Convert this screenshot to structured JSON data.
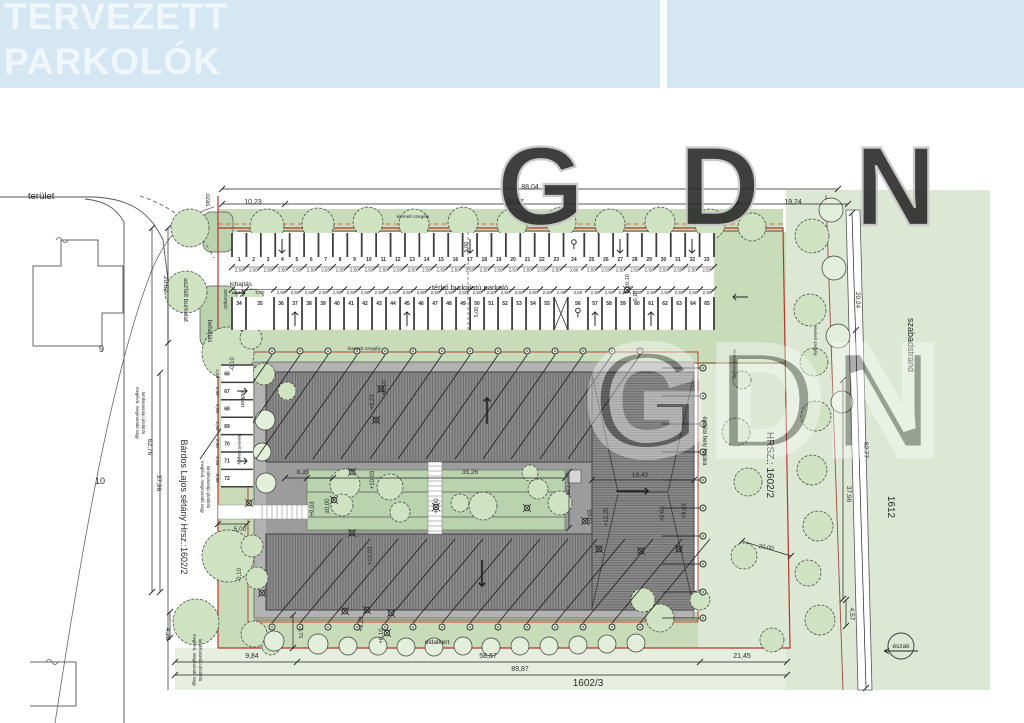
{
  "header": {
    "line1": "TERVEZETT",
    "line2": "PARKOLÓK"
  },
  "watermark": {
    "text": "GDN"
  },
  "colors": {
    "header_bg": "#d6e7f4",
    "header_text": "#eff6fc",
    "site_green": "#dce8d4",
    "strip_green": "#c8dcba",
    "island_green": "#b9d3ae",
    "tree_fill": "#cfe3c3",
    "pale_tree": "#e4efdb",
    "boundary_red": "#b4372b",
    "curb_brown": "#8a7750",
    "roof_gray": "#8a8a8a",
    "slab_gray": "#b2b2b2",
    "corridor_gray": "#9c9c9c"
  },
  "plan": {
    "parking": {
      "row1": {
        "numbers": [
          "1",
          "2",
          "3",
          "4",
          "5",
          "6",
          "7",
          "8",
          "9",
          "10",
          "11",
          "12",
          "13",
          "14",
          "15",
          "16",
          "17",
          "18",
          "19",
          "20",
          "21",
          "22",
          "23",
          "24",
          "25",
          "26",
          "27",
          "28",
          "29",
          "30",
          "31",
          "32",
          "33"
        ],
        "dims": [
          "2,50",
          "2,50",
          "2,50",
          "2,50",
          "2,50",
          "2,50",
          "2,50",
          "2,50",
          "2,50",
          "2,50",
          "2,50",
          "2,50",
          "2,50",
          "2,50",
          "2,50",
          "2,50",
          "2,50",
          "2,50",
          "2,50",
          "2,50",
          "2,50",
          "2,50",
          "2,50",
          "3,60",
          "2,50",
          "2,50",
          "2,50",
          "2,50",
          "2,50",
          "2,50",
          "2,50",
          "2,50",
          "2,50"
        ],
        "disabled_stall": "24"
      },
      "row2": {
        "numbers": [
          "34",
          "35",
          "36",
          "37",
          "38",
          "39",
          "40",
          "41",
          "42",
          "43",
          "44",
          "45",
          "46",
          "47",
          "48",
          "49",
          "50",
          "51",
          "52",
          "53",
          "54",
          "55",
          "",
          "56",
          "57",
          "58",
          "59",
          "60",
          "61",
          "62",
          "63",
          "64",
          "65"
        ],
        "dims": [
          "2,50",
          "5,00",
          "2,50",
          "2,50",
          "2,50",
          "2,50",
          "2,50",
          "2,50",
          "2,50",
          "2,50",
          "2,50",
          "2,50",
          "2,50",
          "2,50",
          "2,50",
          "2,50",
          "2,50",
          "2,50",
          "2,50",
          "2,50",
          "2,50",
          "2,50",
          "2,45",
          "3,60",
          "2,50",
          "2,50",
          "2,50",
          "2,50",
          "2,50",
          "2,50",
          "2,50",
          "2,50",
          "2,50"
        ],
        "disabled_stall": "56"
      },
      "left_column": {
        "numbers": [
          "66",
          "67",
          "68",
          "69",
          "70",
          "71",
          "72"
        ],
        "dims": [
          "2,50",
          "2,50",
          "2,50",
          "2,50",
          "2,50",
          "2,50",
          "2,50"
        ]
      }
    },
    "labels": [
      {
        "t": "terület",
        "x": 28,
        "y": 199,
        "s": 9.5
      },
      {
        "t": "ozás",
        "x": 206,
        "y": 200,
        "s": 6,
        "r": 90,
        "a": "middle"
      },
      {
        "t": "88,04",
        "x": 530,
        "y": 189,
        "s": 7,
        "a": "middle"
      },
      {
        "t": "10,23",
        "x": 253,
        "y": 204,
        "s": 7,
        "a": "middle"
      },
      {
        "t": "58,57",
        "x": 515,
        "y": 204,
        "s": 7,
        "a": "middle"
      },
      {
        "t": "19,24",
        "x": 793,
        "y": 204,
        "s": 7,
        "a": "middle"
      },
      {
        "t": "kiemelt szegély",
        "x": 413,
        "y": 218,
        "s": 4.8,
        "a": "middle"
      },
      {
        "t": "kihajtás",
        "x": 230,
        "y": 286,
        "s": 6.5
      },
      {
        "t": "térkő burkolatú parkoló",
        "x": 470,
        "y": 290,
        "s": 7.5,
        "a": "middle"
      },
      {
        "t": "sorompó",
        "x": 224,
        "y": 299,
        "s": 5,
        "r": 90,
        "a": "middle"
      },
      {
        "t": "behajtás",
        "x": 208,
        "y": 331,
        "s": 6,
        "r": 90,
        "a": "middle"
      },
      {
        "t": "aszfalt burkolat",
        "x": 184,
        "y": 300,
        "s": 6.5,
        "r": 90,
        "a": "middle"
      },
      {
        "t": "20,52",
        "x": 164,
        "y": 284,
        "s": 6.5,
        "r": 90,
        "a": "middle"
      },
      {
        "t": "62,76",
        "x": 148,
        "y": 447,
        "s": 6.5,
        "r": 90,
        "a": "middle"
      },
      {
        "t": "37,96",
        "x": 157,
        "y": 483,
        "s": 6.5,
        "r": 90,
        "a": "middle"
      },
      {
        "t": "Bárdos Lajos sétány Hrsz.:1602/2",
        "x": 181,
        "y": 507,
        "s": 9,
        "r": 90,
        "a": "middle"
      },
      {
        "t": "4,28",
        "x": 166,
        "y": 634,
        "s": 6.5,
        "r": 90,
        "a": "middle"
      },
      {
        "t": "9",
        "x": 99,
        "y": 352,
        "s": 9
      },
      {
        "t": "10",
        "x": 95,
        "y": 484,
        "s": 9
      },
      {
        "t": "meglévő, megmaradó nagy",
        "x": 136,
        "y": 413,
        "s": 4.3,
        "r": 90,
        "a": "middle"
      },
      {
        "t": "lombkoronájú platánfa",
        "x": 142,
        "y": 413,
        "s": 4.3,
        "r": 90,
        "a": "middle"
      },
      {
        "t": "meglévő, megmaradó nagy",
        "x": 201,
        "y": 487,
        "s": 4.3,
        "r": 90,
        "a": "middle"
      },
      {
        "t": "lombkoronájú platánfa",
        "x": 207,
        "y": 487,
        "s": 4.3,
        "r": 90,
        "a": "middle"
      },
      {
        "t": "meglévő, megmaradó nagy",
        "x": 193,
        "y": 660,
        "s": 4.3,
        "r": 90,
        "a": "middle"
      },
      {
        "t": "lombkoronájú platánfa",
        "x": 199,
        "y": 660,
        "s": 4.3,
        "r": 90,
        "a": "middle"
      },
      {
        "t": "előkert",
        "x": 241,
        "y": 399,
        "s": 5.5,
        "r": 90,
        "a": "middle"
      },
      {
        "t": "kiemelt szegély",
        "x": 238,
        "y": 450,
        "s": 4.3,
        "r": 90,
        "a": "middle"
      },
      {
        "t": "-0,10",
        "x": 234,
        "y": 364,
        "s": 6,
        "r": -90,
        "a": "middle"
      },
      {
        "t": "-0,10",
        "x": 241,
        "y": 575,
        "s": 6,
        "r": -90,
        "a": "middle"
      },
      {
        "t": "5,00",
        "x": 240,
        "y": 531,
        "s": 6.5,
        "a": "middle"
      },
      {
        "t": "8,35",
        "x": 303,
        "y": 474,
        "s": 6.5,
        "a": "middle"
      },
      {
        "t": "35,26",
        "x": 470,
        "y": 474,
        "s": 6.5,
        "a": "middle"
      },
      {
        "t": "18,42",
        "x": 640,
        "y": 477,
        "s": 6.5,
        "a": "middle"
      },
      {
        "t": "7,35",
        "x": 566,
        "y": 490,
        "s": 5,
        "r": 90,
        "a": "middle"
      },
      {
        "t": "kiemelt szegély",
        "x": 348,
        "y": 350,
        "s": 4.8
      },
      {
        "t": "±0,10",
        "x": 629,
        "y": 281,
        "s": 5.5,
        "r": -90,
        "a": "middle"
      },
      {
        "t": "0,10",
        "x": 637,
        "y": 296,
        "s": 5.5,
        "r": -90,
        "a": "middle"
      },
      {
        "t": "5,00",
        "x": 468,
        "y": 247,
        "s": 5.5,
        "r": -90,
        "a": "middle"
      },
      {
        "t": "5,00",
        "x": 478,
        "y": 312,
        "s": 5.5,
        "r": -90,
        "a": "middle"
      },
      {
        "t": "kiemelt szegély",
        "x": 733,
        "y": 364,
        "s": 4.3,
        "r": 90,
        "a": "middle"
      },
      {
        "t": "kiemelt szegély",
        "x": 814,
        "y": 341,
        "s": 4.3,
        "r": 90,
        "a": "middle"
      },
      {
        "t": "építési hely határa",
        "x": 703,
        "y": 441,
        "s": 6,
        "r": 90,
        "a": "middle"
      },
      {
        "t": "HRSZ.: 1602/2",
        "x": 767,
        "y": 465,
        "s": 10,
        "r": 90,
        "a": "middle",
        "c": "#4a4a4a"
      },
      {
        "t": "szabadstrand",
        "x": 908,
        "y": 345,
        "s": 9,
        "r": 90,
        "a": "middle",
        "c": "#3a3a3a"
      },
      {
        "t": "20,24",
        "x": 856,
        "y": 300,
        "s": 6.5,
        "r": 90,
        "a": "middle"
      },
      {
        "t": "62,77",
        "x": 864,
        "y": 450,
        "s": 6.5,
        "r": 90,
        "a": "middle"
      },
      {
        "t": "37,96",
        "x": 847,
        "y": 494,
        "s": 6.5,
        "r": 90,
        "a": "middle"
      },
      {
        "t": "4,57",
        "x": 850,
        "y": 614,
        "s": 6.5,
        "r": 90,
        "a": "middle"
      },
      {
        "t": "1612",
        "x": 888,
        "y": 507,
        "s": 10,
        "r": 90,
        "a": "middle",
        "c": "#4a4a4a"
      },
      {
        "t": "20,00",
        "x": 766,
        "y": 549,
        "s": 6,
        "r": 8,
        "a": "middle"
      },
      {
        "t": "9,84",
        "x": 252,
        "y": 658,
        "s": 7,
        "a": "middle"
      },
      {
        "t": "58,57",
        "x": 488,
        "y": 658,
        "s": 7,
        "a": "middle"
      },
      {
        "t": "21,45",
        "x": 742,
        "y": 658,
        "s": 7,
        "a": "middle"
      },
      {
        "t": "89,87",
        "x": 520,
        "y": 671,
        "s": 7,
        "a": "middle"
      },
      {
        "t": "1602/3",
        "x": 588,
        "y": 686,
        "s": 10,
        "a": "middle",
        "c": "#3a3a3a"
      },
      {
        "t": "3,75",
        "x": 299,
        "y": 633,
        "s": 5.5,
        "r": 90,
        "a": "middle"
      },
      {
        "t": "oldalkert",
        "x": 437,
        "y": 644,
        "s": 6.5,
        "a": "middle"
      },
      {
        "t": "+9,23",
        "x": 374,
        "y": 402,
        "s": 6,
        "r": -90,
        "a": "middle"
      },
      {
        "t": "+6,10",
        "x": 386,
        "y": 388,
        "s": 6,
        "r": -90,
        "a": "middle"
      },
      {
        "t": "+10,03",
        "x": 374,
        "y": 480,
        "s": 6,
        "r": -90,
        "a": "middle"
      },
      {
        "t": "±0,00",
        "x": 329,
        "y": 506,
        "s": 6,
        "r": -90,
        "a": "middle"
      },
      {
        "t": "+9,03",
        "x": 314,
        "y": 509,
        "s": 6,
        "r": -90,
        "a": "middle"
      },
      {
        "t": "+0,00",
        "x": 438,
        "y": 506,
        "s": 6,
        "r": -90,
        "a": "middle"
      },
      {
        "t": "+10,03",
        "x": 372,
        "y": 556,
        "s": 6,
        "r": -90,
        "a": "middle"
      },
      {
        "t": "+9,65",
        "x": 592,
        "y": 517,
        "s": 6,
        "r": -90,
        "a": "middle"
      },
      {
        "t": "+12,25",
        "x": 608,
        "y": 517,
        "s": 6,
        "r": -90,
        "a": "middle"
      },
      {
        "t": "+9,60",
        "x": 664,
        "y": 514,
        "s": 6,
        "r": -90,
        "a": "middle"
      },
      {
        "t": "+9,03",
        "x": 686,
        "y": 511,
        "s": 6,
        "r": -90,
        "a": "middle"
      },
      {
        "t": "+9,23",
        "x": 363,
        "y": 624,
        "s": 6,
        "r": -90,
        "a": "middle"
      },
      {
        "t": "+6,10",
        "x": 383,
        "y": 636,
        "s": 6,
        "r": -90,
        "a": "middle"
      },
      {
        "t": "észak",
        "x": 901,
        "y": 648,
        "s": 6.5,
        "a": "middle",
        "c": "#222222"
      }
    ],
    "level_markers": [
      [
        249,
        503
      ],
      [
        334,
        500
      ],
      [
        352,
        472
      ],
      [
        352,
        533
      ],
      [
        436,
        507
      ],
      [
        527,
        508
      ],
      [
        585,
        521
      ],
      [
        599,
        549
      ],
      [
        641,
        551
      ],
      [
        679,
        549
      ],
      [
        262,
        593
      ],
      [
        345,
        611
      ],
      [
        391,
        613
      ],
      [
        381,
        389
      ],
      [
        376,
        420
      ],
      [
        627,
        290
      ],
      [
        367,
        610
      ],
      [
        387,
        633
      ]
    ],
    "arrows": [
      {
        "x": 282,
        "y": 239,
        "d": "down",
        "l": 14
      },
      {
        "x": 470,
        "y": 239,
        "d": "down",
        "l": 14
      },
      {
        "x": 620,
        "y": 239,
        "d": "down",
        "l": 14
      },
      {
        "x": 692,
        "y": 239,
        "d": "down",
        "l": 14
      },
      {
        "x": 295,
        "y": 326,
        "d": "up",
        "l": 14
      },
      {
        "x": 407,
        "y": 326,
        "d": "up",
        "l": 14
      },
      {
        "x": 595,
        "y": 326,
        "d": "up",
        "l": 14
      },
      {
        "x": 651,
        "y": 326,
        "d": "up",
        "l": 14
      },
      {
        "x": 232,
        "y": 293,
        "d": "right",
        "l": 13
      },
      {
        "x": 748,
        "y": 297,
        "d": "left",
        "l": 15
      },
      {
        "x": 237,
        "y": 391,
        "d": "right",
        "l": 10
      },
      {
        "x": 237,
        "y": 461,
        "d": "right",
        "l": 10
      },
      {
        "x": 487,
        "y": 424,
        "d": "up",
        "l": 26,
        "w": 1.6
      },
      {
        "x": 616,
        "y": 491,
        "d": "right",
        "l": 32,
        "w": 1.6
      },
      {
        "x": 482,
        "y": 560,
        "d": "down",
        "l": 26,
        "w": 1.6
      }
    ],
    "trees": [
      [
        267,
        226,
        17
      ],
      [
        318,
        224,
        16
      ],
      [
        368,
        222,
        15
      ],
      [
        414,
        224,
        15
      ],
      [
        463,
        222,
        15
      ],
      [
        512,
        224,
        15
      ],
      [
        561,
        222,
        15
      ],
      [
        610,
        224,
        15
      ],
      [
        660,
        222,
        15
      ],
      [
        710,
        224,
        15
      ],
      [
        752,
        227,
        14
      ],
      [
        812,
        236,
        17
      ],
      [
        190,
        228,
        19
      ],
      [
        186,
        292,
        21
      ],
      [
        228,
        353,
        26
      ],
      [
        252,
        302,
        13
      ],
      [
        251,
        338,
        11
      ],
      [
        264,
        374,
        11
      ],
      [
        287,
        391,
        9
      ],
      [
        265,
        420,
        10,
        1
      ],
      [
        262,
        452,
        9,
        1
      ],
      [
        266,
        483,
        10,
        1
      ],
      [
        228,
        556,
        26
      ],
      [
        252,
        546,
        11
      ],
      [
        257,
        578,
        11
      ],
      [
        196,
        622,
        23
      ],
      [
        254,
        634,
        13
      ],
      [
        271,
        646,
        9
      ],
      [
        345,
        484,
        15
      ],
      [
        390,
        487,
        13
      ],
      [
        342,
        505,
        11
      ],
      [
        400,
        512,
        10
      ],
      [
        460,
        503,
        9
      ],
      [
        483,
        506,
        14
      ],
      [
        538,
        489,
        10
      ],
      [
        560,
        503,
        12
      ],
      [
        530,
        473,
        8
      ],
      [
        736,
        432,
        14
      ],
      [
        748,
        482,
        14
      ],
      [
        744,
        556,
        13
      ],
      [
        810,
        310,
        16
      ],
      [
        814,
        362,
        14
      ],
      [
        816,
        416,
        15
      ],
      [
        812,
        470,
        15
      ],
      [
        818,
        526,
        15
      ],
      [
        808,
        573,
        13
      ],
      [
        820,
        620,
        15
      ],
      [
        772,
        640,
        12
      ],
      [
        660,
        618,
        14
      ],
      [
        643,
        600,
        12
      ],
      [
        700,
        600,
        10
      ],
      [
        742,
        380,
        9
      ],
      [
        831,
        210,
        12,
        1
      ],
      [
        834,
        268,
        12,
        1
      ],
      [
        838,
        336,
        12,
        1
      ],
      [
        842,
        402,
        11,
        1
      ],
      [
        274,
        641,
        10,
        1
      ],
      [
        318,
        644,
        10,
        1
      ],
      [
        348,
        646,
        9,
        1
      ],
      [
        378,
        646,
        9,
        1
      ],
      [
        406,
        647,
        9,
        1
      ],
      [
        434,
        647,
        9,
        1
      ],
      [
        463,
        646,
        9,
        1
      ],
      [
        491,
        647,
        9,
        1
      ],
      [
        520,
        646,
        9,
        1
      ],
      [
        549,
        646,
        9,
        1
      ],
      [
        578,
        645,
        9,
        1
      ],
      [
        607,
        644,
        9,
        1
      ],
      [
        636,
        643,
        9,
        1
      ]
    ],
    "bollards": {
      "top_x": [
        272,
        300,
        328,
        357,
        385,
        413,
        442,
        470,
        498,
        527,
        555,
        583,
        612,
        640
      ],
      "top_y": 351,
      "bottom_x": [
        272,
        300,
        328,
        357,
        385,
        413,
        442,
        470,
        498,
        527,
        555,
        583,
        612,
        640
      ],
      "bottom_y": 627,
      "right_x": 703,
      "right_y": [
        368,
        396,
        424,
        452,
        480,
        508,
        536,
        564,
        592,
        618
      ]
    }
  }
}
